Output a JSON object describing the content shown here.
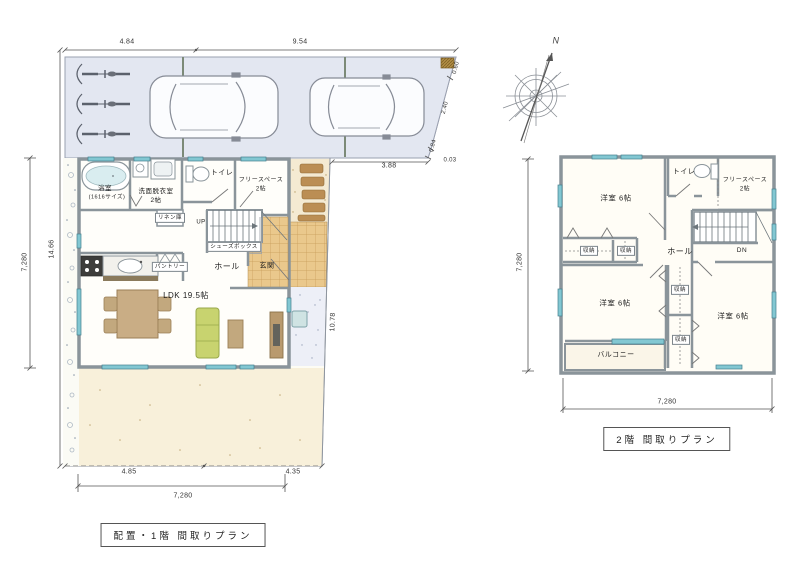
{
  "compass": {
    "north": "N"
  },
  "floor1": {
    "title": "配置・1階 間取りプラン",
    "rooms": {
      "bath": "浴室",
      "bath_size": "(1616サイズ)",
      "washroom": "洗面脱衣室",
      "washroom_size": "2帖",
      "toilet": "トイレ",
      "free_space": "フリースペース",
      "free_space_size": "2帖",
      "linen": "リネン庫",
      "up": "UP",
      "shoe_box": "シューズボックス",
      "hall": "ホール",
      "entrance": "玄関",
      "pantry": "パントリー",
      "ldk": "LDK 19.5帖"
    },
    "dims": {
      "top_w1": "4.84",
      "top_w2": "9.54",
      "site_depth": "14.66",
      "house_depth": "7,280",
      "road_cut": "3.88",
      "e1": "0.60",
      "e2": "2.40",
      "e3": "0.84",
      "e4": "0.03",
      "east_len": "10.78",
      "bot_w1": "4.85",
      "bot_w2": "4.35",
      "house_width": "7,280"
    }
  },
  "floor2": {
    "title": "2階 間取りプラン",
    "rooms": {
      "bedroom_nw": "洋室 6帖",
      "toilet": "トイレ",
      "free_space": "フリースペース",
      "free_space_size": "2帖",
      "closet_a": "収納",
      "closet_b": "収納",
      "hall": "ホール",
      "down": "DN",
      "bedroom_sw": "洋室 6帖",
      "closet_c": "収納",
      "bedroom_se": "洋室 6帖",
      "closet_d": "収納",
      "balcony": "バルコニー"
    },
    "dims": {
      "depth": "7,280",
      "width": "7,280"
    }
  }
}
